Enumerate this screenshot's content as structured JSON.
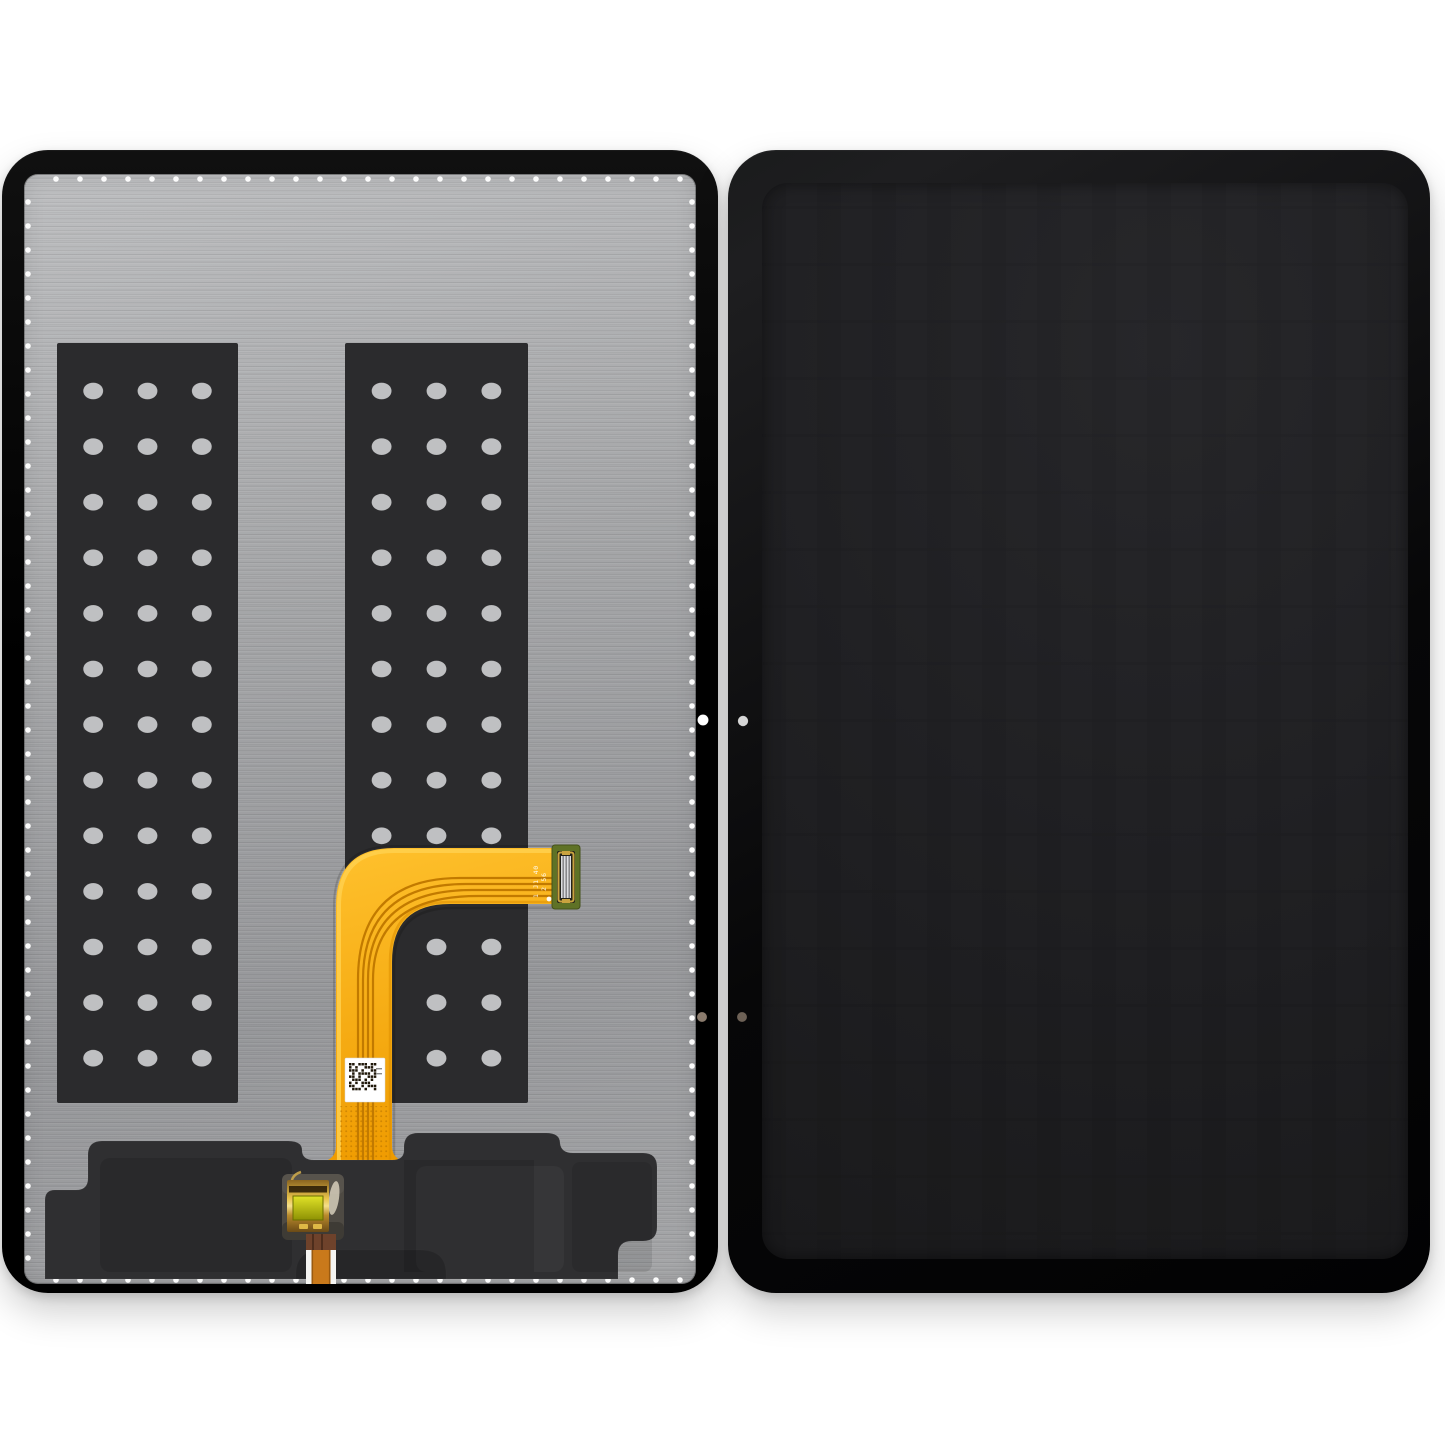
{
  "colors": {
    "page_bg": "#ffffff",
    "frame_top": "#101010",
    "frame_bottom": "#000000",
    "bezel_light": "#1e1e20",
    "bezel_dark": "#070708",
    "screen_light": "#27272a",
    "screen_dark": "#1a1a1c",
    "metal_light": "#bdbec0",
    "metal_mid": "#a5a6a8",
    "metal_dark": "#96979a"
  },
  "back_panel": {
    "perforations": {
      "color": "#fbfbfb",
      "spacing": 24,
      "radius": 2.8,
      "top": {
        "y": 179,
        "from": 56,
        "to": 688
      },
      "bottom": {
        "y": 1280,
        "from": 56,
        "to": 688
      },
      "left": {
        "x": 28,
        "from": 202,
        "to": 1258
      },
      "right": {
        "x": 692,
        "from": 202,
        "to": 1258
      }
    },
    "adhesive_strips": {
      "fill": "#2b2b2d",
      "hole_fill": "#bfc0c2",
      "hole_rx": 10,
      "hole_ry": 8.4,
      "rows": 13,
      "row_start": 391,
      "row_step": 55.6,
      "col_fractions": [
        0.2,
        0.5,
        0.8
      ],
      "rects": [
        {
          "x": 57,
          "y": 343,
          "w": 181,
          "h": 760
        },
        {
          "x": 345,
          "y": 343,
          "w": 183,
          "h": 760
        }
      ]
    },
    "flex_cable": {
      "gradient_start": "#ffc22e",
      "gradient_end": "#ef9b00",
      "edge_highlight": "#ffd04e",
      "edge_shade": "#dd8e00",
      "trace_color": "#c27a00",
      "markings": [
        "1 J1 40",
        "2 56"
      ],
      "marking_color": "#ffffff",
      "connector": {
        "pcb": "#5f7226",
        "pcb_edge": "#44511a",
        "frame": "#c9a33f",
        "pin_light": "#dcdde0",
        "pin_dark": "#88898c",
        "slot": "#23231a"
      }
    },
    "qr_label": {
      "bg": "#ffffff",
      "module": "#20180a",
      "microtext_color": "#8a8a8a",
      "pattern": [
        "110111011",
        "101001110",
        "111010011",
        "010111101",
        "110100111",
        "011101010",
        "101011100",
        "110010111",
        "011101001"
      ]
    },
    "speaker_assembly": {
      "fill": "#2f2f31"
    },
    "board_connector": {
      "patch": "#4e4a43",
      "gold_hi": "#f5e08a",
      "gold": "#e8c24a",
      "gold_dark": "#6b4a16",
      "chip_light": "#e0e228",
      "chip_dark": "#8e9204",
      "bar": "#2e1f08"
    },
    "ribbon_cable": {
      "jacket": "#f4f4f2",
      "brown": "#6e422b",
      "stripe": "#48291a",
      "core": "#c9791b",
      "core_edge": "#9a5a10"
    },
    "holes": [
      {
        "name": "back-camera-hole",
        "x": 703,
        "y": 720,
        "r": 5.5,
        "color": "#ffffff"
      },
      {
        "name": "back-sensor-hole",
        "x": 702,
        "y": 1017,
        "r": 5.0,
        "color": "#8a7b6d"
      },
      {
        "name": "front-camera-dot",
        "x": 743,
        "y": 721,
        "r": 5.2,
        "color": "#d6d6d6"
      },
      {
        "name": "front-sensor-dot",
        "x": 742,
        "y": 1017,
        "r": 5.0,
        "color": "#6d6156"
      }
    ]
  }
}
